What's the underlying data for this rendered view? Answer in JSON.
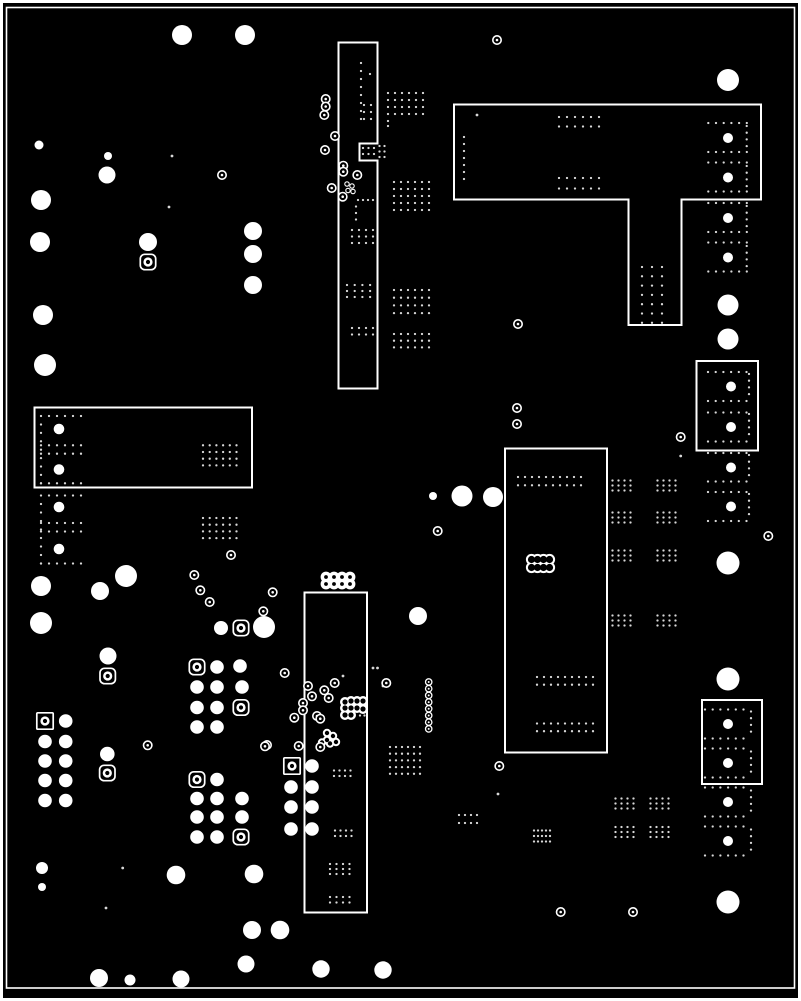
{
  "canvas": {
    "width": 801,
    "height": 1001,
    "background": "#000000",
    "copper_outline": "#ffffff",
    "dot_color": "#d8d8d8"
  },
  "frame": {
    "outer": {
      "x": 1.5,
      "y": 1.5,
      "w": 798,
      "h": 998,
      "stroke": 3
    },
    "inner": {
      "x": 6.5,
      "y": 7.5,
      "w": 788,
      "h": 980.5,
      "stroke": 1.6
    }
  },
  "regions": [
    {
      "id": "pour-top-center",
      "points": "338.5,42.5 377.5,42.5 377.5,143.5 359.5,143.5 359.5,160.5 377.5,160.5 377.5,388.5 338.5,388.5"
    },
    {
      "id": "pour-top-right-T",
      "points": "454,104.5 761,104.5 761,199.5 681.5,199.5 681.5,325 628.5,325 628.5,199.5 454,199.5"
    },
    {
      "id": "pour-left-middle",
      "points": "34.5,407.5 252,407.5 252,487.5 34.5,487.5"
    },
    {
      "id": "pour-right-middle",
      "points": "696.5,361 758,361 758,450.5 696.5,450.5"
    },
    {
      "id": "pour-center-right",
      "points": "505,448.5 607,448.5 607,752.5 505,752.5"
    },
    {
      "id": "pour-bottom-center",
      "points": "304.5,592.5 367,592.5 367,912.5 304.5,912.5"
    },
    {
      "id": "pour-right-bottom",
      "points": "702,700 762,700 762,784 702,784"
    }
  ],
  "vias_filled": [
    [
      182,
      35,
      10
    ],
    [
      245,
      35,
      10
    ],
    [
      728,
      80,
      11
    ],
    [
      39,
      145,
      4.5
    ],
    [
      108,
      156,
      4
    ],
    [
      107,
      175,
      8.5
    ],
    [
      41,
      200,
      10
    ],
    [
      40,
      242,
      10
    ],
    [
      148,
      242,
      9
    ],
    [
      253,
      231,
      9
    ],
    [
      253,
      254,
      9
    ],
    [
      253,
      285,
      9
    ],
    [
      43,
      315,
      10
    ],
    [
      45,
      365,
      11
    ],
    [
      433,
      496,
      4
    ],
    [
      462,
      496,
      10.5
    ],
    [
      493,
      497,
      10
    ],
    [
      126,
      576,
      11
    ],
    [
      41,
      586,
      10
    ],
    [
      100,
      591,
      9
    ],
    [
      41,
      623,
      11
    ],
    [
      108,
      656,
      8.5
    ],
    [
      221,
      628,
      7
    ],
    [
      264,
      627,
      11
    ],
    [
      418,
      616,
      9
    ],
    [
      728,
      305,
      10.5
    ],
    [
      728,
      339,
      10.5
    ],
    [
      728,
      563,
      11.5
    ],
    [
      728,
      679,
      11.5
    ],
    [
      728,
      902,
      11.5
    ],
    [
      42,
      868,
      6
    ],
    [
      42,
      887,
      4
    ],
    [
      176,
      875,
      9.3
    ],
    [
      254,
      874,
      9.3
    ],
    [
      252,
      930,
      9
    ],
    [
      246,
      964,
      8.5
    ],
    [
      99,
      978,
      9
    ],
    [
      130,
      980,
      5.5
    ],
    [
      181,
      979,
      8.5
    ],
    [
      280,
      930,
      9.3
    ],
    [
      321,
      969,
      8.7
    ],
    [
      383,
      970,
      8.7
    ],
    [
      107.3,
      754,
      7.3
    ],
    [
      59,
      429,
      5.3
    ],
    [
      59,
      469.5,
      5.3
    ],
    [
      59,
      507,
      5.3
    ],
    [
      59,
      549,
      5.3
    ],
    [
      728,
      138,
      5
    ],
    [
      728,
      177.5,
      5
    ],
    [
      728,
      218,
      5
    ],
    [
      728,
      257.5,
      5
    ],
    [
      731,
      386.5,
      5
    ],
    [
      731,
      427,
      5
    ],
    [
      731,
      467.5,
      5
    ],
    [
      731,
      506.5,
      5
    ],
    [
      728,
      724,
      5
    ],
    [
      728,
      763,
      5
    ],
    [
      728,
      802,
      5
    ],
    [
      728,
      841,
      5
    ]
  ],
  "pad_block_circles": [
    [
      65.7,
      721
    ],
    [
      45,
      741.5
    ],
    [
      65.7,
      741.5
    ],
    [
      45,
      761
    ],
    [
      65.7,
      761
    ],
    [
      45,
      780.5
    ],
    [
      65.7,
      780.5
    ],
    [
      45,
      800.5
    ],
    [
      65.7,
      800.5
    ],
    [
      217,
      667
    ],
    [
      240,
      666
    ],
    [
      197,
      687
    ],
    [
      217,
      687
    ],
    [
      242,
      687
    ],
    [
      197,
      707.5
    ],
    [
      217,
      707.5
    ],
    [
      197,
      727
    ],
    [
      217,
      727
    ],
    [
      217,
      779.5
    ],
    [
      197,
      798.5
    ],
    [
      217,
      798.5
    ],
    [
      242,
      798.5
    ],
    [
      197,
      817
    ],
    [
      217,
      817
    ],
    [
      242,
      817
    ],
    [
      197,
      837
    ],
    [
      217,
      837
    ],
    [
      312,
      766
    ],
    [
      291,
      787
    ],
    [
      312,
      787
    ],
    [
      291,
      807
    ],
    [
      312,
      807
    ],
    [
      291,
      829
    ],
    [
      312,
      829
    ]
  ],
  "pad_block_radius": 6.8,
  "rounded_square_pads": [
    [
      148,
      262
    ],
    [
      241,
      628
    ],
    [
      107.7,
      676
    ],
    [
      107.3,
      773
    ],
    [
      197,
      667
    ],
    [
      241,
      707.5
    ],
    [
      197,
      779.5
    ],
    [
      241,
      837
    ]
  ],
  "square_pads": [
    [
      45,
      721
    ],
    [
      292,
      766
    ]
  ],
  "rings": [
    [
      222,
      175
    ],
    [
      497,
      40
    ],
    [
      518,
      324
    ],
    [
      325.7,
      99
    ],
    [
      325.7,
      106.5
    ],
    [
      324.3,
      115
    ],
    [
      335,
      136
    ],
    [
      325,
      150
    ],
    [
      343.3,
      165.7
    ],
    [
      343.3,
      171.7
    ],
    [
      357.3,
      175
    ],
    [
      331.7,
      188
    ],
    [
      342.7,
      196.7
    ],
    [
      517,
      408
    ],
    [
      517,
      424
    ],
    [
      437.7,
      531
    ],
    [
      680.7,
      437
    ],
    [
      768.3,
      536
    ],
    [
      231,
      555
    ],
    [
      194.3,
      575
    ],
    [
      200.3,
      590.3
    ],
    [
      209.7,
      602
    ],
    [
      263.3,
      611.3
    ],
    [
      272.7,
      592.3
    ],
    [
      284.7,
      673
    ],
    [
      308,
      686
    ],
    [
      312,
      696.3
    ],
    [
      324.3,
      690.3
    ],
    [
      334.7,
      683
    ],
    [
      328.7,
      698
    ],
    [
      303,
      703
    ],
    [
      303,
      710.3
    ],
    [
      294.3,
      717.7
    ],
    [
      317,
      716
    ],
    [
      320.3,
      718.7
    ],
    [
      298.7,
      746
    ],
    [
      320.3,
      747
    ],
    [
      267,
      745
    ],
    [
      386.3,
      683
    ],
    [
      499.3,
      766
    ],
    [
      147.7,
      745.3
    ],
    [
      265,
      746.3
    ],
    [
      560.7,
      912
    ],
    [
      633,
      912
    ]
  ],
  "small_rings": [
    [
      347,
      184
    ],
    [
      352,
      186
    ],
    [
      348,
      190.5
    ],
    [
      353,
      191.5
    ]
  ],
  "ring_chain": {
    "x": 428.7,
    "y_start": 682,
    "count": 8,
    "pitch": 6.7,
    "r": 3.2
  },
  "blobs_outline": [
    {
      "id": "scallop-oval-center-right",
      "r_out": 5.6,
      "r_in": 3.6,
      "centers": [
        [
          531.5,
          559.5
        ],
        [
          537.5,
          559.5
        ],
        [
          543.5,
          559.5
        ],
        [
          549.5,
          559.5
        ],
        [
          531.5,
          567.5
        ],
        [
          537.5,
          567.5
        ],
        [
          543.5,
          567.5
        ],
        [
          549.5,
          567.5
        ]
      ]
    }
  ],
  "blobs_filled": [
    {
      "id": "ring-cluster-2x4",
      "r_out": 5.4,
      "hole": 1.9,
      "centers": [
        [
          326,
          577
        ],
        [
          334,
          577
        ],
        [
          342,
          577
        ],
        [
          350,
          577
        ],
        [
          326,
          584
        ],
        [
          334,
          584
        ],
        [
          342,
          584
        ],
        [
          350,
          584
        ]
      ]
    },
    {
      "id": "scallop-edge-bottom-center",
      "r_out": 5,
      "hole": 2.6,
      "centers": [
        [
          345,
          702
        ],
        [
          351,
          701
        ],
        [
          357,
          701
        ],
        [
          363,
          701
        ],
        [
          345,
          708
        ],
        [
          351,
          708
        ],
        [
          357,
          708
        ],
        [
          363,
          709
        ],
        [
          345,
          715
        ],
        [
          351,
          715
        ]
      ]
    },
    {
      "id": "scallop-small-bottom-center",
      "r_out": 4.2,
      "hole": 2.2,
      "centers": [
        [
          327,
          733
        ],
        [
          333,
          736
        ],
        [
          327,
          740
        ],
        [
          322,
          742.5
        ],
        [
          330,
          743.5
        ],
        [
          336,
          742
        ]
      ]
    }
  ],
  "dot_grids": [
    [
      388,
      93,
      6,
      4,
      7,
      7
    ],
    [
      388,
      121,
      1,
      2,
      0,
      5
    ],
    [
      394,
      182,
      6,
      5,
      7,
      7
    ],
    [
      394,
      290,
      6,
      4,
      7,
      7.7
    ],
    [
      394,
      334,
      6,
      3,
      7,
      6.7
    ],
    [
      361,
      63,
      1,
      8,
      0,
      8
    ],
    [
      370,
      74,
      1,
      1,
      0,
      0
    ],
    [
      364,
      105,
      2,
      3,
      7,
      7
    ],
    [
      363,
      148,
      3,
      2,
      5.5,
      6
    ],
    [
      379.5,
      146,
      2,
      3,
      5,
      5.5
    ],
    [
      358,
      200,
      4,
      1,
      5,
      0
    ],
    [
      356,
      206.5,
      1,
      3,
      0,
      6.5
    ],
    [
      352,
      230,
      4,
      3,
      7,
      6.5
    ],
    [
      347,
      285,
      4,
      3,
      7.7,
      6
    ],
    [
      352,
      328,
      4,
      2,
      7,
      6.5
    ],
    [
      559,
      117,
      6,
      2,
      8,
      9.5
    ],
    [
      559,
      178,
      6,
      2,
      8,
      10.5
    ],
    [
      464,
      137,
      1,
      7,
      0,
      7
    ],
    [
      708.3,
      123,
      6,
      1,
      7.7,
      0
    ],
    [
      708.3,
      152,
      6,
      1,
      7.7,
      0
    ],
    [
      708.3,
      162.5,
      6,
      1,
      7.7,
      0
    ],
    [
      708.3,
      191.5,
      6,
      1,
      7.7,
      0
    ],
    [
      708.3,
      203,
      6,
      1,
      7.7,
      0
    ],
    [
      708.3,
      232,
      6,
      1,
      7.7,
      0
    ],
    [
      708.3,
      242.5,
      6,
      1,
      7.7,
      0
    ],
    [
      708.3,
      271.5,
      6,
      1,
      7.7,
      0
    ],
    [
      746.7,
      126,
      1,
      4,
      0,
      6.7
    ],
    [
      746.7,
      166,
      1,
      4,
      0,
      6.7
    ],
    [
      746.7,
      206,
      1,
      4,
      0,
      6.7
    ],
    [
      746.7,
      246,
      1,
      4,
      0,
      6.7
    ],
    [
      642,
      267,
      3,
      7,
      10,
      9.3
    ],
    [
      41,
      416,
      6,
      1,
      8,
      0
    ],
    [
      41,
      424.5,
      1,
      8,
      0,
      8.4
    ],
    [
      41,
      445.3,
      6,
      1,
      8,
      0
    ],
    [
      41,
      453.7,
      6,
      1,
      8,
      0
    ],
    [
      41,
      483.3,
      6,
      1,
      8,
      0
    ],
    [
      203,
      445.3,
      6,
      4,
      6.7,
      6.7
    ],
    [
      41,
      495.5,
      6,
      1,
      8,
      0
    ],
    [
      41,
      504,
      1,
      8,
      0,
      8.5
    ],
    [
      41,
      523,
      6,
      1,
      8,
      0
    ],
    [
      41,
      531.5,
      6,
      1,
      8,
      0
    ],
    [
      41,
      563.5,
      6,
      1,
      8,
      0
    ],
    [
      203,
      518,
      6,
      4,
      6.7,
      6.7
    ],
    [
      518,
      477,
      10,
      2,
      7,
      8.3
    ],
    [
      537,
      677,
      9,
      2,
      7,
      7.7
    ],
    [
      537,
      723.5,
      9,
      2,
      7,
      7.7
    ],
    [
      612.5,
      480.5,
      4,
      3,
      6,
      5
    ],
    [
      657.5,
      480.5,
      4,
      3,
      6,
      5
    ],
    [
      612.5,
      512.5,
      4,
      3,
      6,
      5
    ],
    [
      657.5,
      512.5,
      4,
      3,
      6,
      5
    ],
    [
      612.5,
      550.5,
      4,
      3,
      6,
      5
    ],
    [
      657.5,
      550.5,
      4,
      3,
      6,
      5
    ],
    [
      612.5,
      615.5,
      4,
      3,
      6,
      5
    ],
    [
      657.5,
      615.5,
      4,
      3,
      6,
      5
    ],
    [
      615.5,
      798.5,
      4,
      3,
      6,
      5
    ],
    [
      650.5,
      798.5,
      4,
      3,
      6,
      5
    ],
    [
      615.5,
      827,
      4,
      3,
      6,
      5
    ],
    [
      650.5,
      827,
      4,
      3,
      6,
      5
    ],
    [
      534,
      830.5,
      5,
      3,
      4,
      5.5
    ],
    [
      459,
      815,
      4,
      2,
      6,
      8
    ],
    [
      390,
      747,
      6,
      5,
      6,
      6.7
    ],
    [
      334,
      770.5,
      4,
      2,
      5.5,
      5.5
    ],
    [
      335,
      830.5,
      4,
      2,
      5.5,
      5.5
    ],
    [
      330,
      864,
      4,
      3,
      6.5,
      5
    ],
    [
      330,
      897,
      4,
      2,
      6.5,
      5.5
    ],
    [
      708,
      372,
      6,
      1,
      7.7,
      0
    ],
    [
      708,
      401,
      6,
      1,
      7.7,
      0
    ],
    [
      708,
      412.5,
      6,
      1,
      7.7,
      0
    ],
    [
      708,
      441.5,
      6,
      1,
      7.7,
      0
    ],
    [
      708,
      453,
      6,
      1,
      7.7,
      0
    ],
    [
      708,
      481.5,
      6,
      1,
      7.7,
      0
    ],
    [
      708,
      492,
      6,
      1,
      7.7,
      0
    ],
    [
      708,
      521,
      6,
      1,
      7.7,
      0
    ],
    [
      749,
      374,
      1,
      4,
      0,
      6.7
    ],
    [
      749,
      414,
      1,
      4,
      0,
      6.7
    ],
    [
      749,
      455,
      1,
      4,
      0,
      6.7
    ],
    [
      749,
      494,
      1,
      4,
      0,
      6.7
    ],
    [
      705,
      709.5,
      6,
      1,
      7.7,
      0
    ],
    [
      705,
      738.5,
      6,
      1,
      7.7,
      0
    ],
    [
      705,
      748.5,
      6,
      1,
      7.7,
      0
    ],
    [
      705,
      777.5,
      6,
      1,
      7.7,
      0
    ],
    [
      705,
      787.5,
      6,
      1,
      7.7,
      0
    ],
    [
      705,
      816.5,
      6,
      1,
      7.7,
      0
    ],
    [
      705,
      826.5,
      6,
      1,
      7.7,
      0
    ],
    [
      705,
      855.5,
      6,
      1,
      7.7,
      0
    ],
    [
      751,
      711.5,
      1,
      4,
      0,
      6.7
    ],
    [
      751,
      751.5,
      1,
      4,
      0,
      6.7
    ],
    [
      751,
      790.5,
      1,
      4,
      0,
      6.7
    ],
    [
      751,
      829.5,
      1,
      4,
      0,
      6.7
    ],
    [
      360,
      702,
      2,
      4,
      4.5,
      4.5
    ]
  ],
  "dot_radius": 1.15,
  "single_dots": [
    [
      172,
      156
    ],
    [
      169,
      207
    ],
    [
      477,
      115
    ],
    [
      680.7,
      456
    ],
    [
      122.7,
      868
    ],
    [
      106,
      908
    ],
    [
      343,
      676
    ],
    [
      373,
      668
    ],
    [
      377.5,
      668
    ],
    [
      383,
      686
    ],
    [
      498,
      794
    ]
  ]
}
